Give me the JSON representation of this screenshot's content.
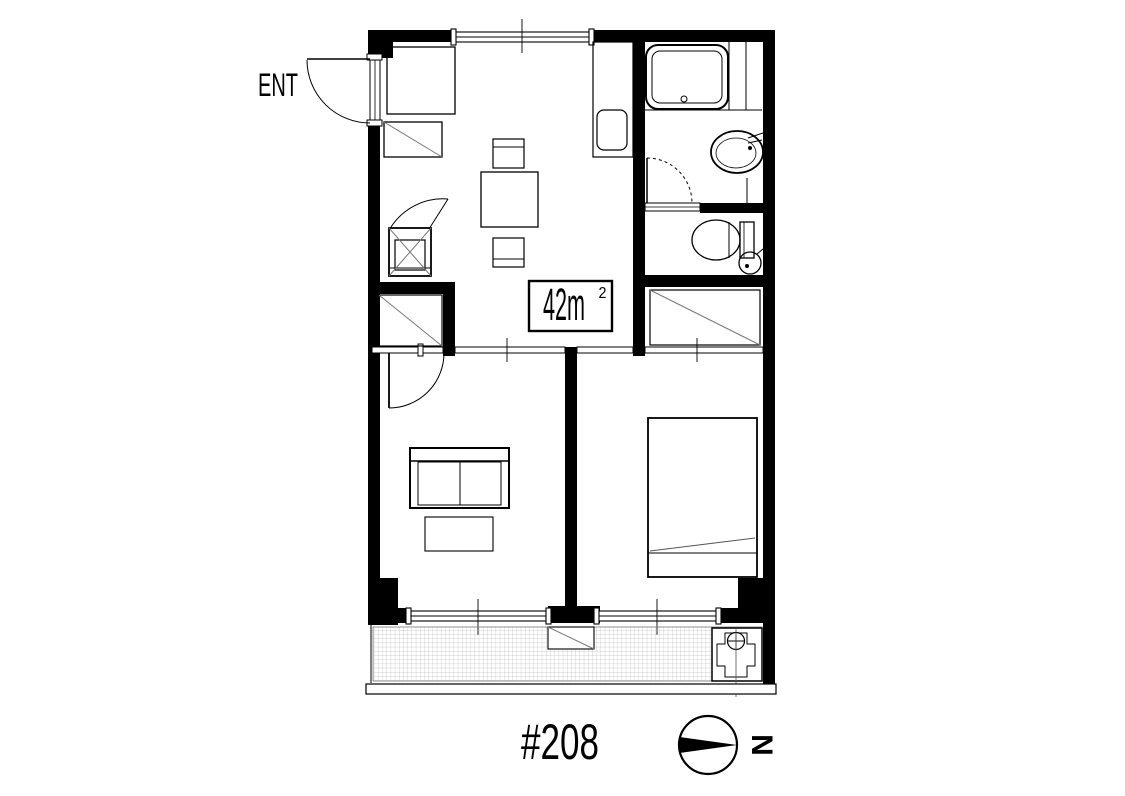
{
  "page": {
    "background": "#ffffff"
  },
  "floor_plan": {
    "entrance_label": "ENT",
    "area": {
      "main": "42m",
      "sup": "2",
      "full": "42m²"
    },
    "unit_number": "#208",
    "compass_letter": "N",
    "colors": {
      "wall": "#000000",
      "line": "#000000",
      "detail_gray": "#787878",
      "hatch": "#bfbfbf",
      "background": "#ffffff"
    }
  }
}
